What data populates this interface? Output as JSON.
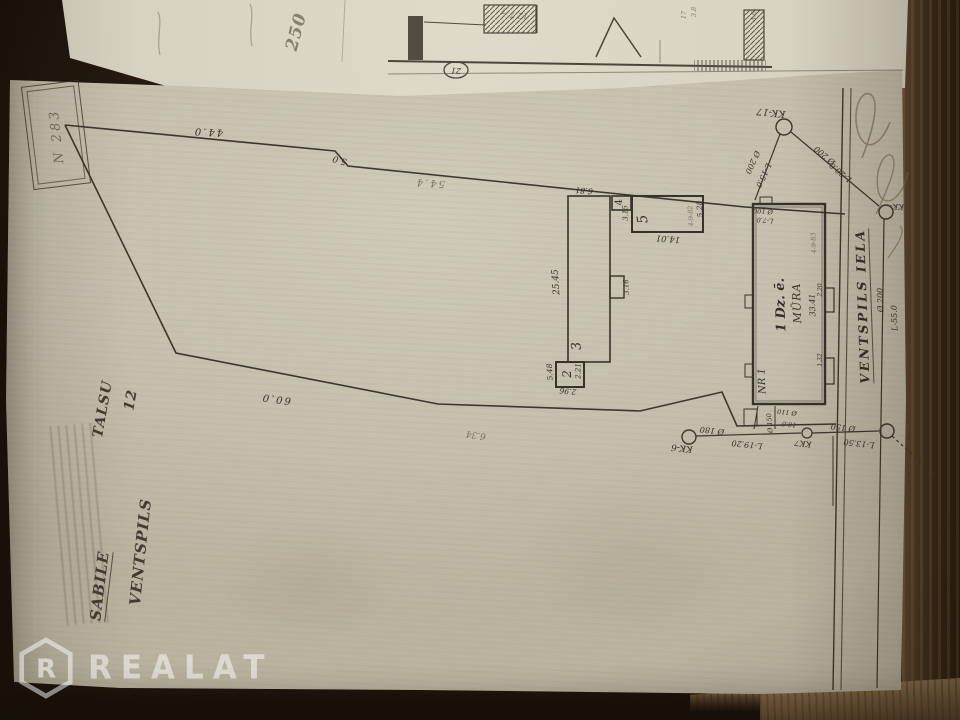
{
  "registry": {
    "number": "N 283"
  },
  "parcel": {
    "dim_top": "44.0",
    "dim_jog": "5.0",
    "dim_top2": "54.4",
    "dim_bottom": "60.0",
    "dim_bottom2": "6.34"
  },
  "street": {
    "name": "VENTSPILS IELA",
    "main_d": "Ø 200",
    "main_l": "L-55.0"
  },
  "manholes": {
    "kk17": "KK-17",
    "kk6": "KK-6",
    "kk7": "KK7",
    "kk_street": "KK-"
  },
  "pipes": {
    "p1_d": "Ø 200",
    "p1_l": "L-15.0",
    "p2_d": "Ø 200",
    "p2_l": "L-20.0",
    "p3_d": "Ø 180",
    "p3_l": "L-19.20",
    "p4_d": "Ø 150",
    "p4_l": "L-13.50",
    "yard_d": "Ø 150",
    "yard_l": "16.0",
    "yard_d2": "Ø 110",
    "house_d": "Ø 100",
    "house_l": "L-7.0"
  },
  "buildings": {
    "b1": {
      "label": "1 Dz. ē.",
      "material": "MŪRA",
      "nr": "NR 1",
      "length": "33.41",
      "note": "4-9-83",
      "porch1": "2.20",
      "porch2": "1.32"
    },
    "b2": {
      "num": "2",
      "w": "5.48",
      "l": "2.96",
      "note": "2.21"
    },
    "b3": {
      "num": "3",
      "length": "25.45",
      "width": "6.81"
    },
    "b4": {
      "num": "4",
      "dim": "3.15"
    },
    "b5": {
      "num": "5",
      "length": "14.01",
      "width": "5.28",
      "note": "4-9-82"
    },
    "annex": {
      "dim": "3.16"
    }
  },
  "address": {
    "town": "SABILE",
    "district": "TALSU",
    "street": "VENTSPILS",
    "number": "12"
  },
  "top_sheet": {
    "hand_number": "250",
    "n7": "7",
    "n127": "12.7",
    "circled": "21",
    "t1": "3.8",
    "t2": "17",
    "t3": "4.6"
  },
  "watermark": {
    "logo_letter": "R",
    "brand": "REALAT"
  }
}
